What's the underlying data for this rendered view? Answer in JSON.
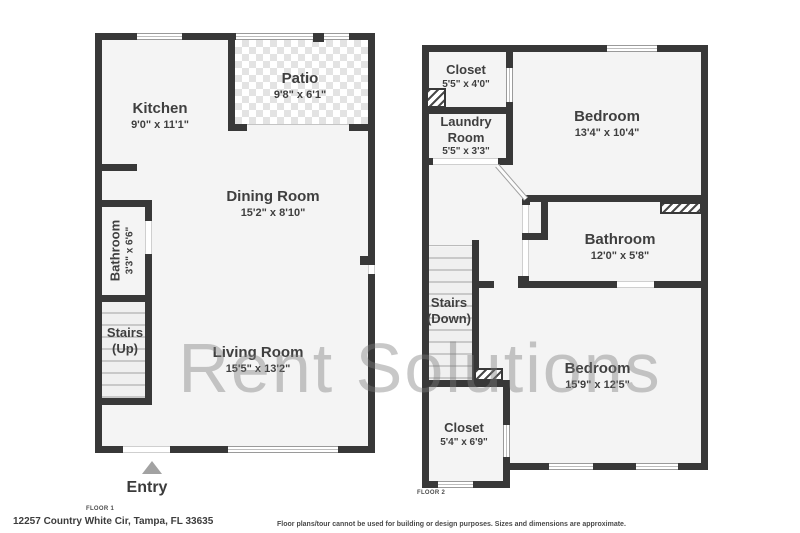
{
  "watermark": "Rent Solutions",
  "floor1": {
    "label": "FLOOR 1",
    "entry": "Entry",
    "rooms": [
      {
        "name": "Kitchen",
        "dims": "9'0\" x 11'1\""
      },
      {
        "name": "Patio",
        "dims": "9'8\" x 6'1\""
      },
      {
        "name": "Dining Room",
        "dims": "15'2\" x 8'10\""
      },
      {
        "name": "Bathroom",
        "dims": "3'3\" x 6'6\""
      },
      {
        "name": "Stairs",
        "dims": "(Up)"
      },
      {
        "name": "Living Room",
        "dims": "15'5\" x 13'2\""
      }
    ]
  },
  "floor2": {
    "label": "FLOOR 2",
    "rooms": [
      {
        "name": "Closet",
        "dims": "5'5\" x 4'0\""
      },
      {
        "name": "Laundry Room",
        "dims": "5'5\" x 3'3\""
      },
      {
        "name": "Bedroom",
        "dims": "13'4\" x 10'4\""
      },
      {
        "name": "Bathroom",
        "dims": "12'0\" x 5'8\""
      },
      {
        "name": "Stairs",
        "dims": "(Down)"
      },
      {
        "name": "Bedroom",
        "dims": "15'9\" x 12'5\""
      },
      {
        "name": "Closet",
        "dims": "5'4\" x 6'9\""
      }
    ]
  },
  "footer": {
    "address": "12257 Country White Cir, Tampa, FL 33635",
    "disclaimer": "Floor plans/tour cannot be used for building or design purposes. Sizes and dimensions are approximate."
  },
  "colors": {
    "wall": "#383838",
    "interior": "#f4f4f4",
    "watermark_gray": "#7d7d7d"
  }
}
